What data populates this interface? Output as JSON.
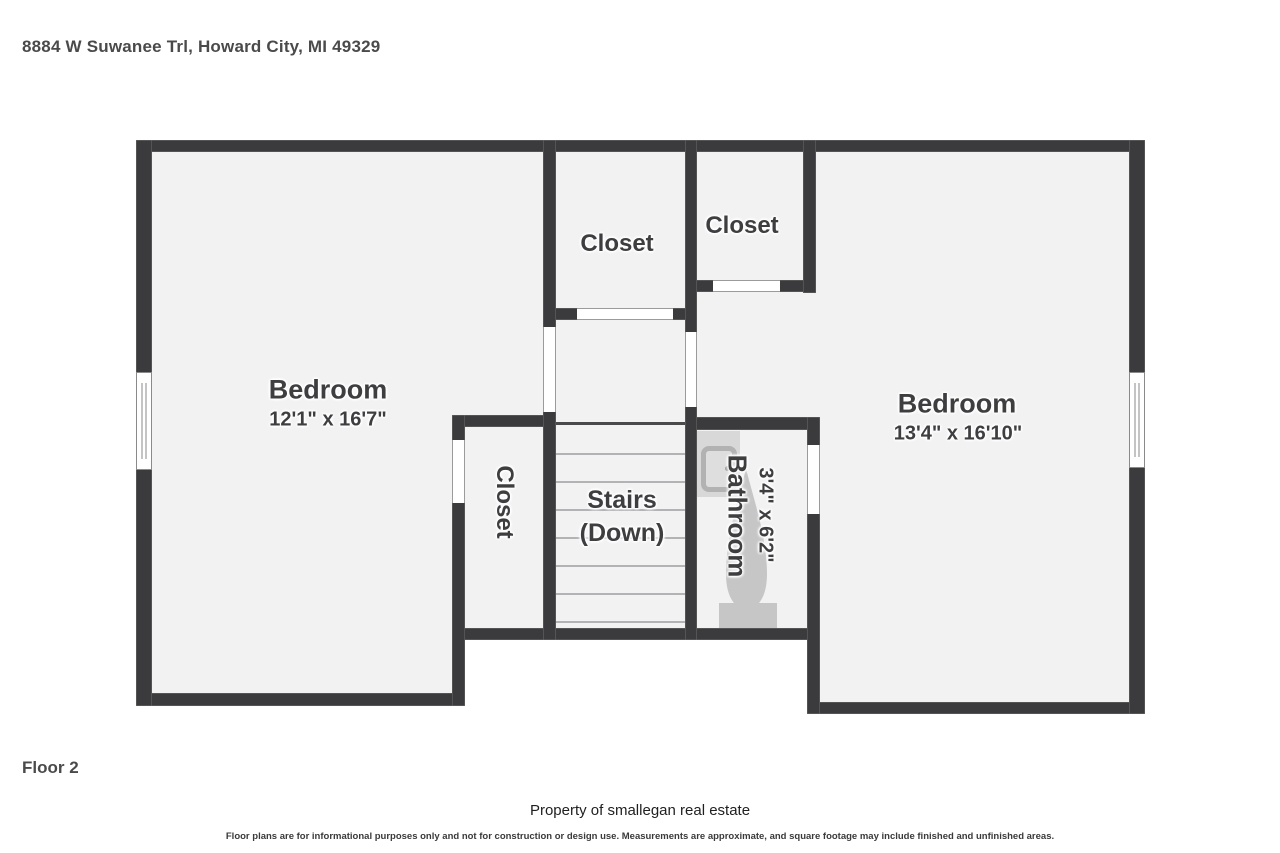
{
  "header": {
    "address": "8884 W Suwanee Trl, Howard City, MI 49329"
  },
  "floor_label": "Floor 2",
  "footer": {
    "property_line": "Property of smallegan real estate",
    "disclaimer": "Floor plans are for informational purposes only and not for construction or design use. Measurements are approximate, and square footage may include finished and unfinished areas."
  },
  "rooms": {
    "bedroom_left": {
      "name": "Bedroom",
      "dims": "12'1\" x 16'7\""
    },
    "bedroom_right": {
      "name": "Bedroom",
      "dims": "13'4\" x 16'10\""
    },
    "closet_top_left": {
      "name": "Closet"
    },
    "closet_top_right": {
      "name": "Closet"
    },
    "closet_lower": {
      "name": "Closet"
    },
    "stairs": {
      "line1": "Stairs",
      "line2": "(Down)"
    },
    "bathroom": {
      "name": "Bathroom",
      "dims": "3'4\" x 6'2\""
    }
  },
  "colors": {
    "wall": "#3b3b3d",
    "room_fill": "#f2f2f3",
    "fixture": "#c6c6c6",
    "label": "#3e3e40"
  }
}
